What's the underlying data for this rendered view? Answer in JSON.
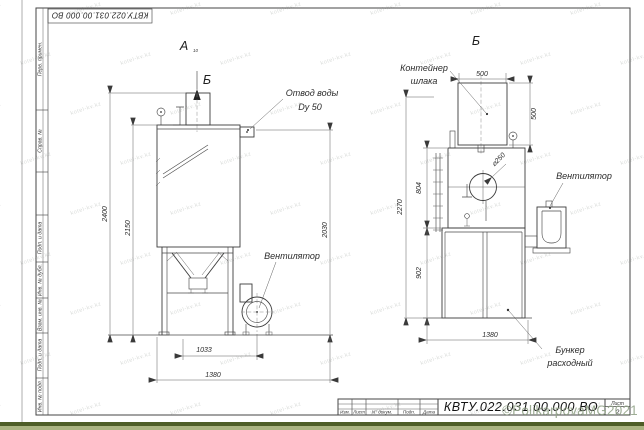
{
  "sheet": {
    "stamp_designation": "КВТУ.022.031.00.000  ВО",
    "frame_labels": {
      "perv_primen": "Перв. примен.",
      "sprav_no": "Справ. №",
      "podp_data_1": "Подп. и дата",
      "inv_dubl": "Инв. № дубл.",
      "vzam_inv": "Взам. инв. №",
      "podp_data_2": "Подп. и дата",
      "inv_podl": "Инв. № подл."
    },
    "title_block": {
      "revision_columns": [
        "Изм.",
        "Лист",
        "N° докум.",
        "Подп.",
        "Дата"
      ],
      "designation": "КВТУ.022.031.00.000  ВО",
      "sheet_label": "Лист",
      "sheet_number": "2"
    }
  },
  "views": {
    "front": {
      "view_letter": "А",
      "view_letter_sub": "10",
      "section_mark": "Б",
      "callouts": {
        "water_drain_line1": "Отвод воды",
        "water_drain_line2": "Dy 50",
        "fan": "Вентилятор"
      },
      "dims": {
        "overall_height": "2400",
        "body_height": "2150",
        "height_to_drain": "2030",
        "width_to_fan_axis": "1033",
        "overall_width": "1380"
      }
    },
    "section_b": {
      "title": "Б",
      "callouts": {
        "slag_container_line1": "Контейнер",
        "slag_container_line2": "шлака",
        "fan": "Вентилятор",
        "hopper_line1": "Бункер",
        "hopper_line2": "расходный",
        "inlet_diameter": "⌀250"
      },
      "dims": {
        "container_width": "500",
        "container_height": "500",
        "body_height": "804",
        "overall_height": "2270",
        "hopper_height": "902",
        "hopper_width": "1380"
      }
    }
  },
  "watermark": {
    "copyright": "©PolikarpovaMG2021",
    "tile_text": "kotel-kv.kz"
  }
}
